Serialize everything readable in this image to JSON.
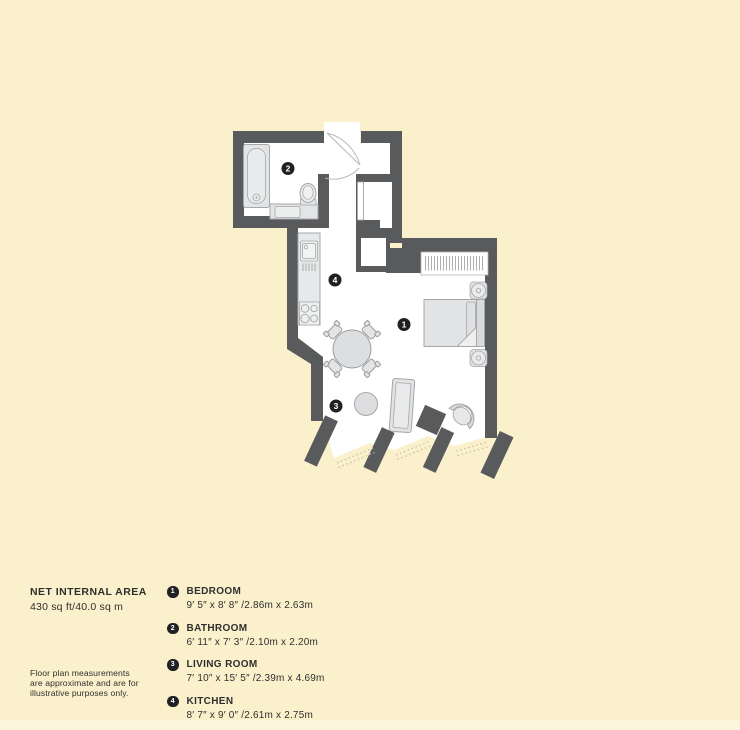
{
  "area": {
    "title": "NET INTERNAL AREA",
    "value": "430 sq ft/40.0 sq m"
  },
  "disclaimer": {
    "line1": "Floor plan measurements",
    "line2": "are approximate and are for",
    "line3": "illustrative purposes only."
  },
  "legend": {
    "items": [
      {
        "number": "1",
        "name": "BEDROOM",
        "dimensions": "9′ 5″ x 8′ 8″ /2.86m x 2.63m"
      },
      {
        "number": "2",
        "name": "BATHROOM",
        "dimensions": "6′ 11″ x 7′ 3″ /2.10m x 2.20m"
      },
      {
        "number": "3",
        "name": "LIVING ROOM",
        "dimensions": "7′ 10″ x 15′ 5″ /2.39m x 4.69m"
      },
      {
        "number": "4",
        "name": "KITCHEN",
        "dimensions": "8′ 7″ x 9′ 0″ /2.61m x 2.75m"
      }
    ]
  },
  "plan": {
    "badges": [
      {
        "number": "1",
        "room": "bedroom"
      },
      {
        "number": "2",
        "room": "bathroom"
      },
      {
        "number": "3",
        "room": "living-room"
      },
      {
        "number": "4",
        "room": "kitchen"
      }
    ],
    "colors": {
      "background": "#faf1cc",
      "wall": "#595a5c",
      "floor": "#ffffff",
      "fixture_fill": "#e3e4e5",
      "fixture_stroke": "#a6a7a9",
      "badge": "#202122",
      "window_dash": "#c9c1a4"
    }
  }
}
